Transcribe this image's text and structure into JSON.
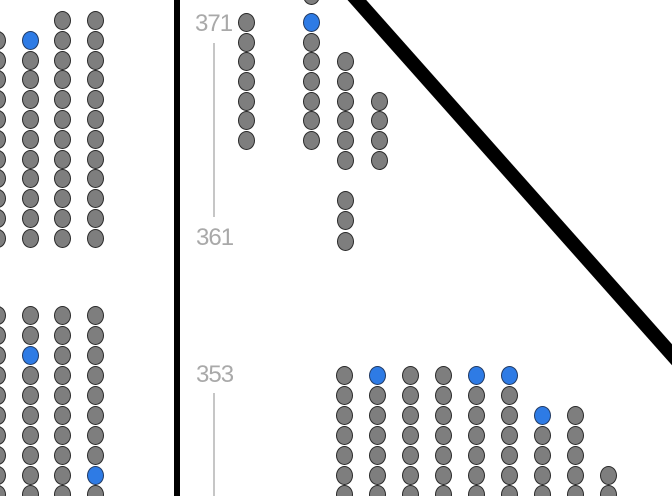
{
  "app": {
    "view": "stadium-seat-map"
  },
  "colors": {
    "background": "#ffffff",
    "seat_available": "#2e7be5",
    "seat_available_stroke": "#213a63",
    "seat_unavailable": "#7e7e7e",
    "seat_unavailable_stroke": "#2a2a2a",
    "section_label": "#a9a9a9",
    "rail_line": "#c6c6c6",
    "boundary_line": "#000000"
  },
  "sections": {
    "labels": [
      {
        "text": "371",
        "x": 195,
        "y": 24
      },
      {
        "text": "361",
        "x": 196,
        "y": 238
      },
      {
        "text": "353",
        "x": 196,
        "y": 375
      }
    ],
    "rail_segments": [
      {
        "x": 213,
        "y1": 43,
        "y2": 217
      },
      {
        "x": 213,
        "y1": 393,
        "y2": 496
      }
    ]
  },
  "boundaries": {
    "vertical_line": {
      "x": 174,
      "width": 6
    },
    "diagonal_line": {
      "x1": 348,
      "y1": -10,
      "x2": 690,
      "y2": 375,
      "width": 14
    }
  },
  "seat_style": {
    "width": 17,
    "height": 19
  },
  "seat_groups": [
    {
      "name": "left-upper-block",
      "columns": [
        {
          "x": -3,
          "seats": [
            {
              "y": 40,
              "state": "unavailable"
            },
            {
              "y": 60,
              "state": "unavailable"
            },
            {
              "y": 79,
              "state": "unavailable"
            },
            {
              "y": 99,
              "state": "unavailable"
            },
            {
              "y": 119,
              "state": "unavailable"
            },
            {
              "y": 139,
              "state": "unavailable"
            },
            {
              "y": 159,
              "state": "unavailable"
            },
            {
              "y": 178,
              "state": "unavailable"
            },
            {
              "y": 198,
              "state": "unavailable"
            },
            {
              "y": 218,
              "state": "unavailable"
            },
            {
              "y": 238,
              "state": "unavailable"
            }
          ]
        },
        {
          "x": 30,
          "seats": [
            {
              "y": 40,
              "state": "available"
            },
            {
              "y": 60,
              "state": "unavailable"
            },
            {
              "y": 79,
              "state": "unavailable"
            },
            {
              "y": 99,
              "state": "unavailable"
            },
            {
              "y": 119,
              "state": "unavailable"
            },
            {
              "y": 139,
              "state": "unavailable"
            },
            {
              "y": 159,
              "state": "unavailable"
            },
            {
              "y": 178,
              "state": "unavailable"
            },
            {
              "y": 198,
              "state": "unavailable"
            },
            {
              "y": 218,
              "state": "unavailable"
            },
            {
              "y": 238,
              "state": "unavailable"
            }
          ]
        },
        {
          "x": 62,
          "seats": [
            {
              "y": 20,
              "state": "unavailable"
            },
            {
              "y": 40,
              "state": "unavailable"
            },
            {
              "y": 60,
              "state": "unavailable"
            },
            {
              "y": 79,
              "state": "unavailable"
            },
            {
              "y": 99,
              "state": "unavailable"
            },
            {
              "y": 119,
              "state": "unavailable"
            },
            {
              "y": 139,
              "state": "unavailable"
            },
            {
              "y": 159,
              "state": "unavailable"
            },
            {
              "y": 178,
              "state": "unavailable"
            },
            {
              "y": 198,
              "state": "unavailable"
            },
            {
              "y": 218,
              "state": "unavailable"
            },
            {
              "y": 238,
              "state": "unavailable"
            }
          ]
        },
        {
          "x": 95,
          "seats": [
            {
              "y": 20,
              "state": "unavailable"
            },
            {
              "y": 40,
              "state": "unavailable"
            },
            {
              "y": 60,
              "state": "unavailable"
            },
            {
              "y": 79,
              "state": "unavailable"
            },
            {
              "y": 99,
              "state": "unavailable"
            },
            {
              "y": 119,
              "state": "unavailable"
            },
            {
              "y": 139,
              "state": "unavailable"
            },
            {
              "y": 159,
              "state": "unavailable"
            },
            {
              "y": 178,
              "state": "unavailable"
            },
            {
              "y": 198,
              "state": "unavailable"
            },
            {
              "y": 218,
              "state": "unavailable"
            },
            {
              "y": 238,
              "state": "unavailable"
            }
          ]
        }
      ]
    },
    {
      "name": "left-lower-block",
      "columns": [
        {
          "x": -3,
          "seats": [
            {
              "y": 315,
              "state": "unavailable"
            },
            {
              "y": 335,
              "state": "unavailable"
            },
            {
              "y": 355,
              "state": "unavailable"
            },
            {
              "y": 375,
              "state": "unavailable"
            },
            {
              "y": 395,
              "state": "unavailable"
            },
            {
              "y": 415,
              "state": "unavailable"
            },
            {
              "y": 435,
              "state": "unavailable"
            },
            {
              "y": 455,
              "state": "unavailable"
            },
            {
              "y": 475,
              "state": "unavailable"
            },
            {
              "y": 494,
              "state": "unavailable"
            }
          ]
        },
        {
          "x": 30,
          "seats": [
            {
              "y": 315,
              "state": "unavailable"
            },
            {
              "y": 335,
              "state": "unavailable"
            },
            {
              "y": 355,
              "state": "available"
            },
            {
              "y": 375,
              "state": "unavailable"
            },
            {
              "y": 395,
              "state": "unavailable"
            },
            {
              "y": 415,
              "state": "unavailable"
            },
            {
              "y": 435,
              "state": "unavailable"
            },
            {
              "y": 455,
              "state": "unavailable"
            },
            {
              "y": 475,
              "state": "unavailable"
            },
            {
              "y": 494,
              "state": "unavailable"
            }
          ]
        },
        {
          "x": 62,
          "seats": [
            {
              "y": 315,
              "state": "unavailable"
            },
            {
              "y": 335,
              "state": "unavailable"
            },
            {
              "y": 355,
              "state": "unavailable"
            },
            {
              "y": 375,
              "state": "unavailable"
            },
            {
              "y": 395,
              "state": "unavailable"
            },
            {
              "y": 415,
              "state": "unavailable"
            },
            {
              "y": 435,
              "state": "unavailable"
            },
            {
              "y": 455,
              "state": "unavailable"
            },
            {
              "y": 475,
              "state": "unavailable"
            },
            {
              "y": 494,
              "state": "unavailable"
            }
          ]
        },
        {
          "x": 95,
          "seats": [
            {
              "y": 315,
              "state": "unavailable"
            },
            {
              "y": 335,
              "state": "unavailable"
            },
            {
              "y": 355,
              "state": "unavailable"
            },
            {
              "y": 375,
              "state": "unavailable"
            },
            {
              "y": 395,
              "state": "unavailable"
            },
            {
              "y": 415,
              "state": "unavailable"
            },
            {
              "y": 435,
              "state": "unavailable"
            },
            {
              "y": 455,
              "state": "unavailable"
            },
            {
              "y": 475,
              "state": "available"
            },
            {
              "y": 494,
              "state": "unavailable"
            }
          ]
        }
      ]
    },
    {
      "name": "middle-upper-block",
      "columns": [
        {
          "x": 246,
          "seats": [
            {
              "y": 22,
              "state": "unavailable"
            },
            {
              "y": 42,
              "state": "unavailable"
            },
            {
              "y": 61,
              "state": "unavailable"
            },
            {
              "y": 81,
              "state": "unavailable"
            },
            {
              "y": 101,
              "state": "unavailable"
            },
            {
              "y": 120,
              "state": "unavailable"
            },
            {
              "y": 140,
              "state": "unavailable"
            }
          ]
        },
        {
          "x": 311,
          "seats": [
            {
              "y": -5,
              "state": "unavailable"
            },
            {
              "y": 22,
              "state": "available"
            },
            {
              "y": 42,
              "state": "unavailable"
            },
            {
              "y": 61,
              "state": "unavailable"
            },
            {
              "y": 81,
              "state": "unavailable"
            },
            {
              "y": 101,
              "state": "unavailable"
            },
            {
              "y": 120,
              "state": "unavailable"
            },
            {
              "y": 140,
              "state": "unavailable"
            }
          ]
        },
        {
          "x": 345,
          "seats": [
            {
              "y": 61,
              "state": "unavailable"
            },
            {
              "y": 81,
              "state": "unavailable"
            },
            {
              "y": 101,
              "state": "unavailable"
            },
            {
              "y": 120,
              "state": "unavailable"
            },
            {
              "y": 140,
              "state": "unavailable"
            },
            {
              "y": 160,
              "state": "unavailable"
            },
            {
              "y": 200,
              "state": "unavailable"
            },
            {
              "y": 220,
              "state": "unavailable"
            },
            {
              "y": 241,
              "state": "unavailable"
            }
          ]
        },
        {
          "x": 379,
          "seats": [
            {
              "y": 101,
              "state": "unavailable"
            },
            {
              "y": 120,
              "state": "unavailable"
            },
            {
              "y": 140,
              "state": "unavailable"
            },
            {
              "y": 160,
              "state": "unavailable"
            }
          ]
        }
      ]
    },
    {
      "name": "bottom-block",
      "columns": [
        {
          "x": 344,
          "seats": [
            {
              "y": 375,
              "state": "unavailable"
            },
            {
              "y": 395,
              "state": "unavailable"
            },
            {
              "y": 415,
              "state": "unavailable"
            },
            {
              "y": 435,
              "state": "unavailable"
            },
            {
              "y": 455,
              "state": "unavailable"
            },
            {
              "y": 475,
              "state": "unavailable"
            },
            {
              "y": 494,
              "state": "unavailable"
            }
          ]
        },
        {
          "x": 377,
          "seats": [
            {
              "y": 375,
              "state": "available"
            },
            {
              "y": 395,
              "state": "unavailable"
            },
            {
              "y": 415,
              "state": "unavailable"
            },
            {
              "y": 435,
              "state": "unavailable"
            },
            {
              "y": 455,
              "state": "unavailable"
            },
            {
              "y": 475,
              "state": "unavailable"
            },
            {
              "y": 494,
              "state": "unavailable"
            }
          ]
        },
        {
          "x": 410,
          "seats": [
            {
              "y": 375,
              "state": "unavailable"
            },
            {
              "y": 395,
              "state": "unavailable"
            },
            {
              "y": 415,
              "state": "unavailable"
            },
            {
              "y": 435,
              "state": "unavailable"
            },
            {
              "y": 455,
              "state": "unavailable"
            },
            {
              "y": 475,
              "state": "unavailable"
            },
            {
              "y": 494,
              "state": "unavailable"
            }
          ]
        },
        {
          "x": 443,
          "seats": [
            {
              "y": 375,
              "state": "unavailable"
            },
            {
              "y": 395,
              "state": "unavailable"
            },
            {
              "y": 415,
              "state": "unavailable"
            },
            {
              "y": 435,
              "state": "unavailable"
            },
            {
              "y": 455,
              "state": "unavailable"
            },
            {
              "y": 475,
              "state": "unavailable"
            },
            {
              "y": 494,
              "state": "unavailable"
            }
          ]
        },
        {
          "x": 476,
          "seats": [
            {
              "y": 375,
              "state": "available"
            },
            {
              "y": 395,
              "state": "unavailable"
            },
            {
              "y": 415,
              "state": "unavailable"
            },
            {
              "y": 435,
              "state": "unavailable"
            },
            {
              "y": 455,
              "state": "unavailable"
            },
            {
              "y": 475,
              "state": "unavailable"
            },
            {
              "y": 494,
              "state": "unavailable"
            }
          ]
        },
        {
          "x": 509,
          "seats": [
            {
              "y": 375,
              "state": "available"
            },
            {
              "y": 395,
              "state": "unavailable"
            },
            {
              "y": 415,
              "state": "unavailable"
            },
            {
              "y": 435,
              "state": "unavailable"
            },
            {
              "y": 455,
              "state": "unavailable"
            },
            {
              "y": 475,
              "state": "unavailable"
            },
            {
              "y": 494,
              "state": "unavailable"
            }
          ]
        },
        {
          "x": 542,
          "seats": [
            {
              "y": 415,
              "state": "available"
            },
            {
              "y": 435,
              "state": "unavailable"
            },
            {
              "y": 455,
              "state": "unavailable"
            },
            {
              "y": 475,
              "state": "unavailable"
            },
            {
              "y": 494,
              "state": "unavailable"
            }
          ]
        },
        {
          "x": 575,
          "seats": [
            {
              "y": 415,
              "state": "unavailable"
            },
            {
              "y": 435,
              "state": "unavailable"
            },
            {
              "y": 455,
              "state": "unavailable"
            },
            {
              "y": 475,
              "state": "unavailable"
            },
            {
              "y": 494,
              "state": "unavailable"
            }
          ]
        },
        {
          "x": 608,
          "seats": [
            {
              "y": 475,
              "state": "unavailable"
            },
            {
              "y": 494,
              "state": "unavailable"
            }
          ]
        }
      ]
    }
  ]
}
